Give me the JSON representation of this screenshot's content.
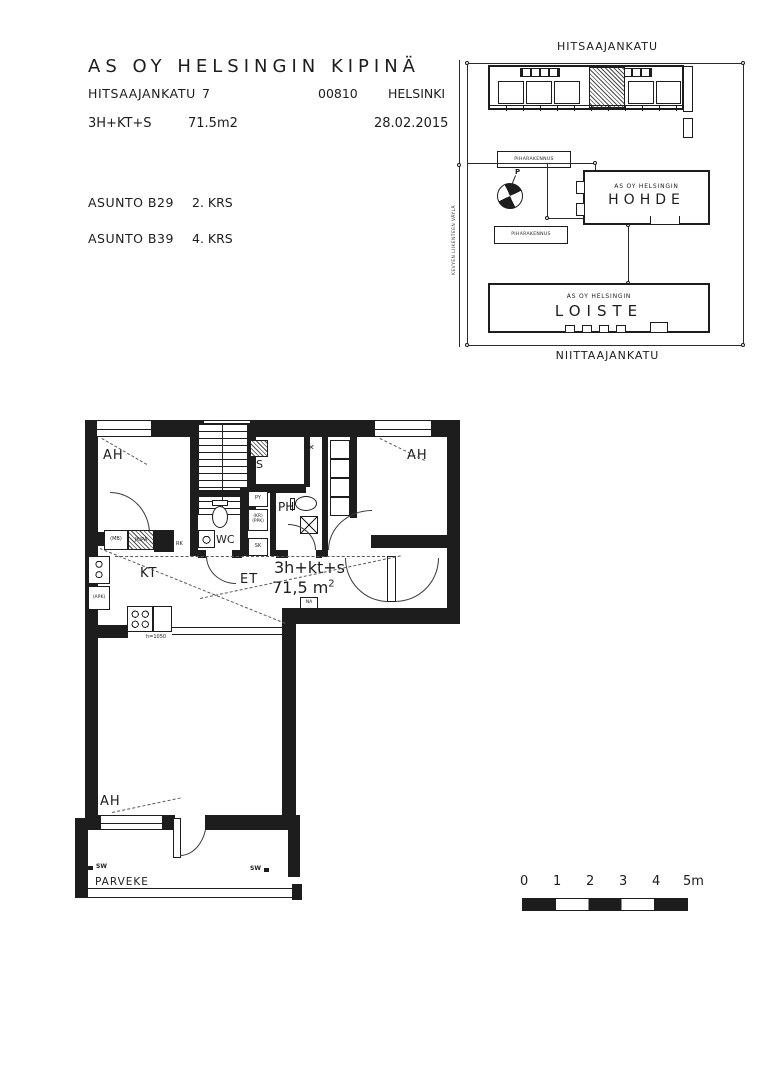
{
  "header": {
    "title": "AS OY HELSINGIN KIPINÄ",
    "street": "HITSAAJANKATU",
    "street_number": "7",
    "postal_code": "00810",
    "city": "HELSINKI",
    "unit_type": "3H+KT+S",
    "unit_area": "71.5m2",
    "date": "28.02.2015",
    "apartments": [
      {
        "unit": "ASUNTO B29",
        "floor": "2. KRS"
      },
      {
        "unit": "ASUNTO B39",
        "floor": "4. KRS"
      }
    ]
  },
  "site_plan": {
    "street_top": "HITSAAJANKATU",
    "street_bottom": "NIITTAAJANKATU",
    "path_label": "KEVYEN LIIKENTEEN VÄYLÄ",
    "outbuilding_1": "PIHARAKENNUS",
    "outbuilding_2": "PIHARAKENNUS",
    "north_label": "P",
    "building_hohde_line1": "AS OY HELSINGIN",
    "building_hohde_line2": "HOHDE",
    "building_loiste_line1": "AS OY HELSINGIN",
    "building_loiste_line2": "LOISTE"
  },
  "floor_plan": {
    "rooms": {
      "ah_top_left": "AH",
      "ah_top_right": "AH",
      "ah_bottom": "AH",
      "kitchen": "KT",
      "hall": "ET",
      "wc": "WC",
      "bathroom": "PH",
      "sauna": "S",
      "balcony": "PARVEKE"
    },
    "unit_label": {
      "type": "3h+kt+s",
      "area": "71,5 m",
      "area_exp": "2"
    },
    "tags": {
      "py": "PY",
      "kr": "(KR)",
      "ppk": "(PPK)",
      "sk": "SK",
      "mb": "(MB)",
      "jk_pa": "JK/PA",
      "rk": "RK",
      "apk": "(APK)",
      "na": "NA",
      "sw_left": "SW",
      "sw_right": "SW",
      "counter_height": "h=1050"
    },
    "icons": {
      "vent": "✕"
    }
  },
  "scale_bar": {
    "ticks": [
      "0",
      "1",
      "2",
      "3",
      "4",
      "5m"
    ]
  },
  "colors": {
    "ink": "#1d1d1d"
  }
}
